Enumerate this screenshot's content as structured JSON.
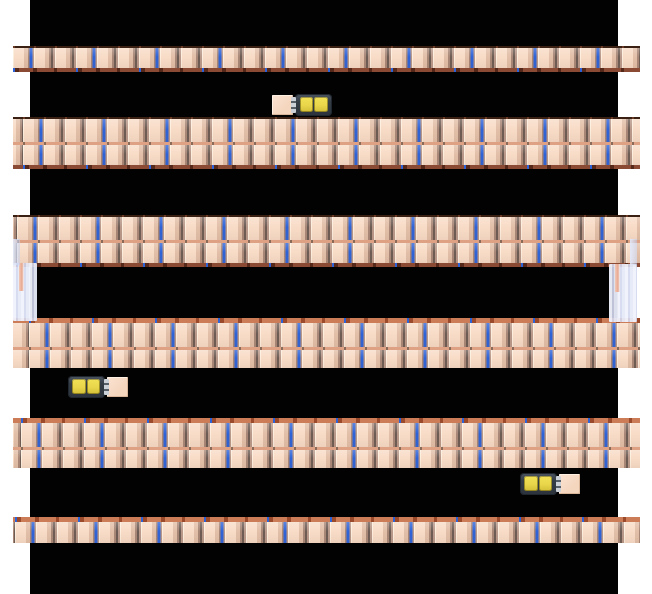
{
  "scene": {
    "canvas_color": "#ffffff",
    "floor": {
      "color": "#020202",
      "x": 30,
      "width": 588,
      "height": 594
    },
    "colors": {
      "cube": "#f8dcc7",
      "cube_highlight": "#fdeedd",
      "cube_shadow": "#e2bfa8",
      "divider": "#6d5c54",
      "divider_blue": "#2e63d8",
      "shelf_front": "#8a4a33",
      "shelf_front_dark": "#55281a",
      "shelf_edge": "#cd7c58",
      "shelf_edge_dark": "#9c4a2c",
      "shelf_mid": "#dfa183",
      "robot_yellow": "#e9d64a",
      "fork": "#ccd1d8",
      "cargo": "#f4d5bd",
      "support_pink": "#e8a98f"
    },
    "rows": [
      {
        "kind": "single-top",
        "x": 13,
        "y": 46,
        "w": 627,
        "shift": 0
      },
      {
        "kind": "double-top",
        "x": 13,
        "y": 117,
        "w": 627,
        "shift": 10
      },
      {
        "kind": "double-top",
        "x": 13,
        "y": 215,
        "w": 627,
        "shift": 4
      },
      {
        "kind": "double-bottom",
        "x": 13,
        "y": 318,
        "w": 627,
        "shift": 16
      },
      {
        "kind": "double-bottom",
        "x": 13,
        "y": 418,
        "w": 627,
        "shift": 8
      },
      {
        "kind": "single-bottom",
        "x": 13,
        "y": 517,
        "w": 627,
        "shift": 2
      }
    ],
    "robots": [
      {
        "x": 272,
        "y": 94,
        "facing": "left"
      },
      {
        "x": 68,
        "y": 376,
        "facing": "right"
      },
      {
        "x": 520,
        "y": 473,
        "facing": "right"
      }
    ],
    "supports": [
      {
        "side": "left",
        "x": 13,
        "y": 263,
        "w": 24,
        "h": 58
      },
      {
        "side": "right",
        "x": 609,
        "y": 264,
        "w": 28,
        "h": 58
      }
    ],
    "edge_hints": [
      {
        "x": 13,
        "y": 239,
        "w": 7,
        "h": 26
      },
      {
        "x": 630,
        "y": 239,
        "w": 7,
        "h": 26
      }
    ]
  }
}
